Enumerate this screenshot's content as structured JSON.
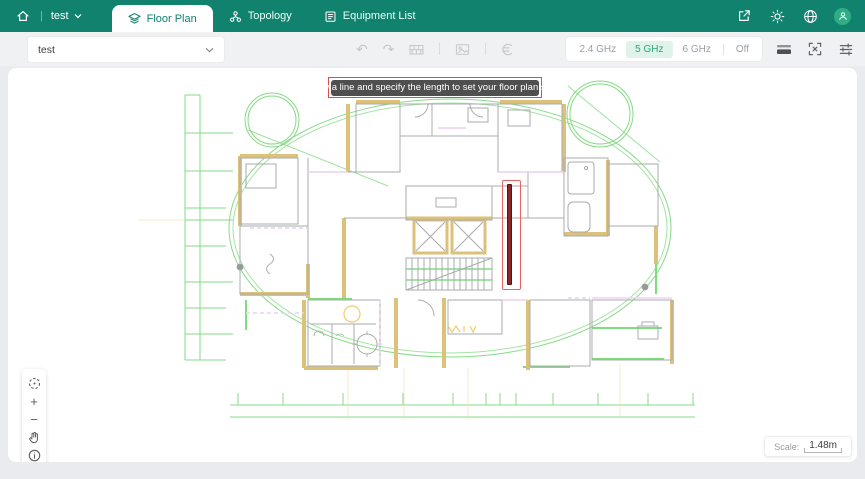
{
  "header": {
    "project_name": "test",
    "tabs": [
      {
        "label": "Floor Plan",
        "active": true
      },
      {
        "label": "Topology",
        "active": false
      },
      {
        "label": "Equipment List",
        "active": false
      }
    ]
  },
  "toolbar": {
    "floor_select_value": "test",
    "undo_glyph": "↶",
    "redo_glyph": "↷",
    "bands": [
      "2.4 GHz",
      "5 GHz",
      "6 GHz",
      "Off"
    ],
    "active_band": "5 GHz"
  },
  "canvas": {
    "tooltip_text": "Draw a line and specify the length to set your floor plan scale",
    "scale_label": "Scale:",
    "scale_value": "1.48m",
    "zoom_in_glyph": "+",
    "zoom_out_glyph": "−"
  },
  "colors": {
    "header_green": "#11826E",
    "accent_green": "#2AA87E",
    "band_active_bg": "#DFF3EA",
    "plan_green": "#84DB84",
    "plan_wall_tan": "#DCC17B",
    "plan_lavender": "#ECCFF3",
    "highlight_red": "#E64747",
    "scale_line_red": "#8C2626"
  }
}
